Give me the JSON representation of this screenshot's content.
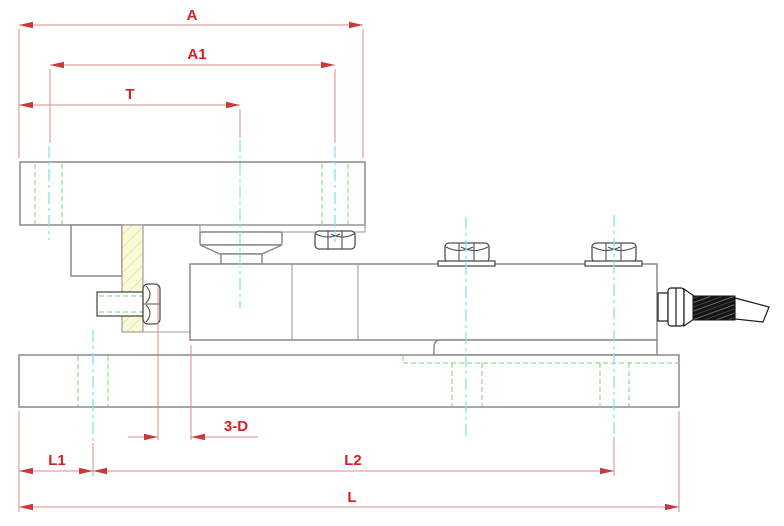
{
  "dims": {
    "A": "A",
    "A1": "A1",
    "T": "T",
    "D3": "3-D",
    "L1": "L1",
    "L2": "L2",
    "L": "L"
  },
  "colors": {
    "dimension_text": "#d42020",
    "dimension_line": "#d98c8c",
    "arrowhead": "#c93a3a",
    "centerline": "#7ee6e6",
    "hidden_line": "#8fd98f",
    "outline": "#8a8a8a",
    "bolt_outline": "#4f4f4f",
    "shim_fill": "#fafad8",
    "shim_hatch": "#e6e69a",
    "cable": "#1a1a1a",
    "background": "#ffffff"
  }
}
